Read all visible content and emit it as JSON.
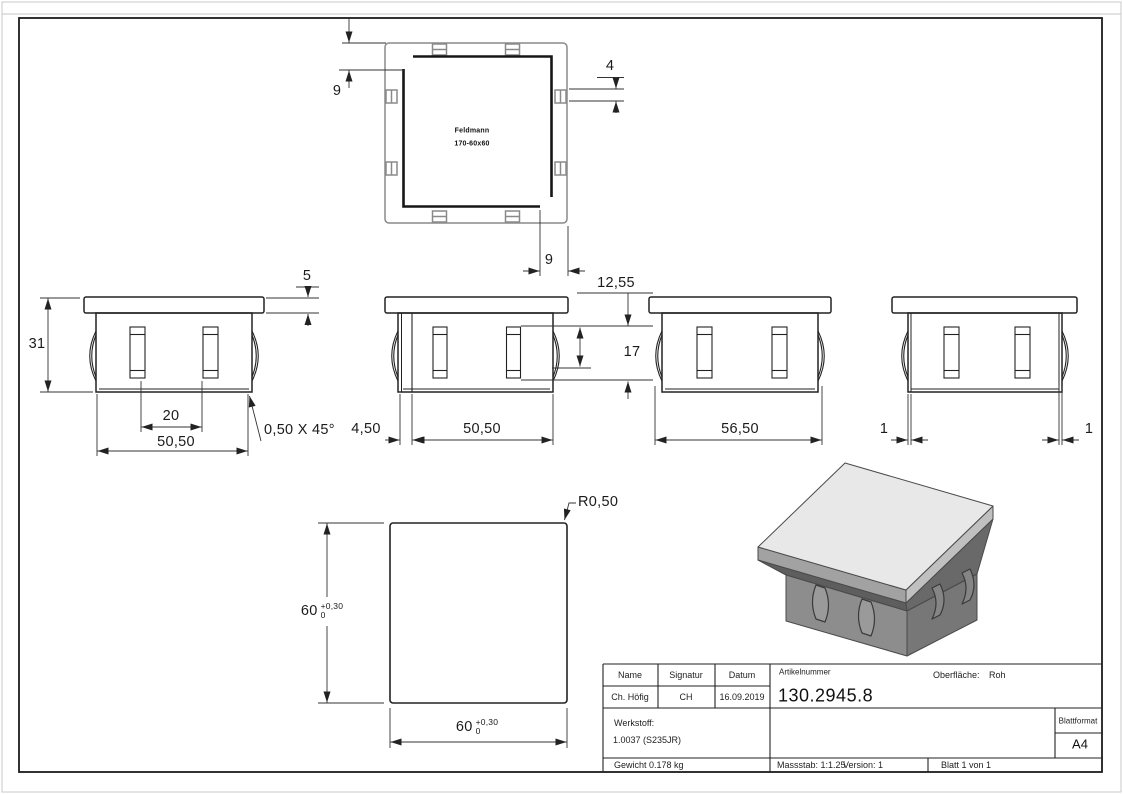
{
  "drawing": {
    "brand": {
      "line1": "Feldmann",
      "line2": "170-60x60"
    },
    "dims": {
      "tv_left": "9",
      "tv_tab": "4",
      "tv_bottom": "9",
      "offset": "12,55",
      "slot_h": "17",
      "flange_t": "5",
      "height": "31",
      "slot_sp": "20",
      "width_v1": "50,50",
      "chamfer": "0,50 X 45°",
      "wall_v2": "4,50",
      "width_v2": "50,50",
      "width_v3": "56,50",
      "wall_left": "1",
      "wall_right": "1",
      "sq_h": "60",
      "sq_w": "60",
      "tol_plus": "+0,30",
      "tol_zero": "0",
      "radius": "R0,50"
    }
  },
  "title_block": {
    "name_label": "Name",
    "signature_label": "Signatur",
    "date_label": "Datum",
    "name_value": "Ch. Höfig",
    "signature_value": "CH",
    "date_value": "16.09.2019",
    "article_label": "Artikelnummer",
    "article_number": "130.2945.8",
    "surface_label": "Oberfläche:",
    "surface_value": "Roh",
    "material_label": "Werkstoff:",
    "material_value": "1.0037 (S235JR)",
    "weight": "Gewicht 0.178 kg",
    "scale": "Massstab: 1:1.25",
    "version": "Version: 1",
    "sheet": "Blatt 1 von 1",
    "format_label": "Blattformat",
    "format_value": "A4"
  },
  "colors": {
    "line": "#1c1c1c",
    "dim_line": "#333333",
    "gray_view": "#8a8a8a",
    "plate_top": "#e8e8e8",
    "plate_side": "#c0c0c0",
    "body_left": "#8d8d8d",
    "body_right": "#777777",
    "shadow": "#5e5e5e"
  }
}
